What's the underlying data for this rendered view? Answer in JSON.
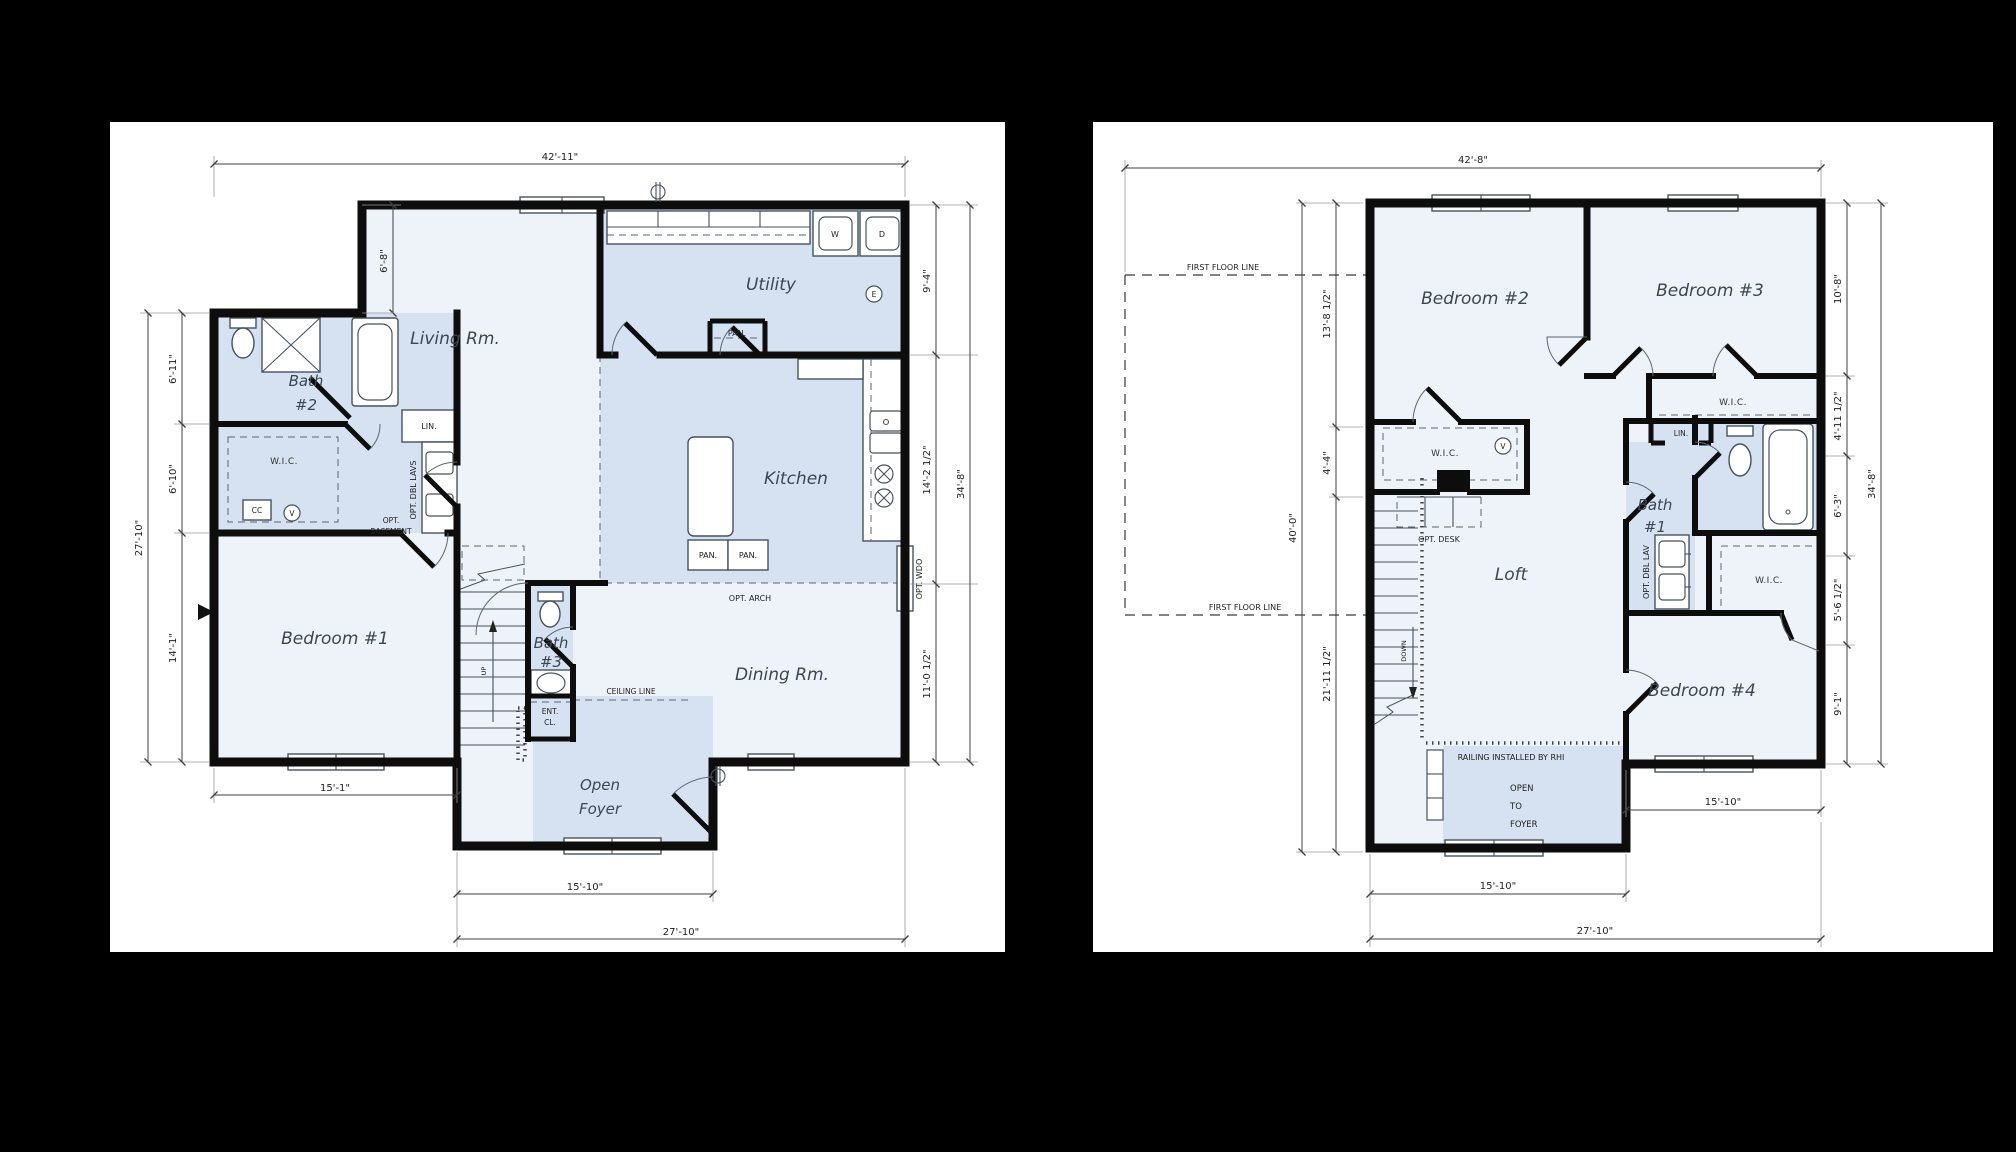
{
  "colors": {
    "background": "#000000",
    "sheet": "#ffffff",
    "wall": "#0d0d0d",
    "room_light": "#eef3fa",
    "room_blue": "#d6e2f2",
    "dim_line": "#3f3f3f"
  },
  "left_plan": {
    "dims": {
      "top": "42'-11\"",
      "upper_left": "6'-8\"",
      "left_segments": [
        "6'-11\"",
        "6'-10\"",
        "14'-1\""
      ],
      "left_overall": "27'-10\"",
      "right_segments": [
        "9'-4\"",
        "14'-2 1/2\"",
        "11'-0 1/2\""
      ],
      "right_overall": "34'-8\"",
      "bottom_left": "15'-1\"",
      "bottom_inner": "15'-10\"",
      "bottom_overall": "27'-10\""
    },
    "rooms": {
      "living": "Living Rm.",
      "utility": "Utility",
      "kitchen": "Kitchen",
      "dining": "Dining Rm.",
      "bedroom1": "Bedroom #1",
      "bath2": [
        "Bath",
        "#2"
      ],
      "bath3": [
        "Bath",
        "#3"
      ],
      "wic": "W.I.C.",
      "foyer": [
        "Open",
        "Foyer"
      ]
    },
    "labels": {
      "lin": "LIN.",
      "opt_dbl_lavs": "OPT. DBL LAVS",
      "pan_utility": "PAN.",
      "pan_kitchen_1": "PAN.",
      "pan_kitchen_2": "PAN.",
      "opt_basement": [
        "OPT.",
        "BASEMENT"
      ],
      "ent_cl": [
        "ENT.",
        "CL."
      ],
      "ceiling_line": "CEILING LINE",
      "opt_arch": "OPT. ARCH",
      "opt_wdo": "OPT. WDO",
      "cc": "CC",
      "washer": "W",
      "dryer": "D",
      "up": "UP",
      "e_symbol": "E",
      "v_symbol": "V"
    }
  },
  "right_plan": {
    "dims": {
      "top": "42'-8\"",
      "left_segments": [
        "13'-8 1/2\"",
        "4'-4\"",
        "21'-11 1/2\""
      ],
      "left_overall": "40'-0\"",
      "right_segments": [
        "10'-8\"",
        "4'-11 1/2\"",
        "6'-3\"",
        "5'-6 1/2\"",
        "9'-1\""
      ],
      "right_overall": "34'-8\"",
      "mid_right": "15'-10\"",
      "bottom_inner": "15'-10\"",
      "bottom_overall": "27'-10\""
    },
    "rooms": {
      "bedroom2": "Bedroom #2",
      "bedroom3": "Bedroom #3",
      "bedroom4": "Bedroom #4",
      "loft": "Loft",
      "bath1": [
        "Bath",
        "#1"
      ],
      "wic_b2": "W.I.C.",
      "wic_b3": "W.I.C.",
      "wic_b4": "W.I.C."
    },
    "labels": {
      "lin": "LIN.",
      "opt_dbl_lav": "OPT. DBL LAV",
      "opt_desk": "OPT. DESK",
      "down": "DOWN",
      "railing": "RAILING INSTALLED BY RHI",
      "open_to_foyer": [
        "OPEN",
        "TO",
        "FOYER"
      ],
      "first_floor_line_top": "FIRST FLOOR LINE",
      "first_floor_line_bottom": "FIRST FLOOR LINE",
      "v_symbol": "V"
    }
  }
}
